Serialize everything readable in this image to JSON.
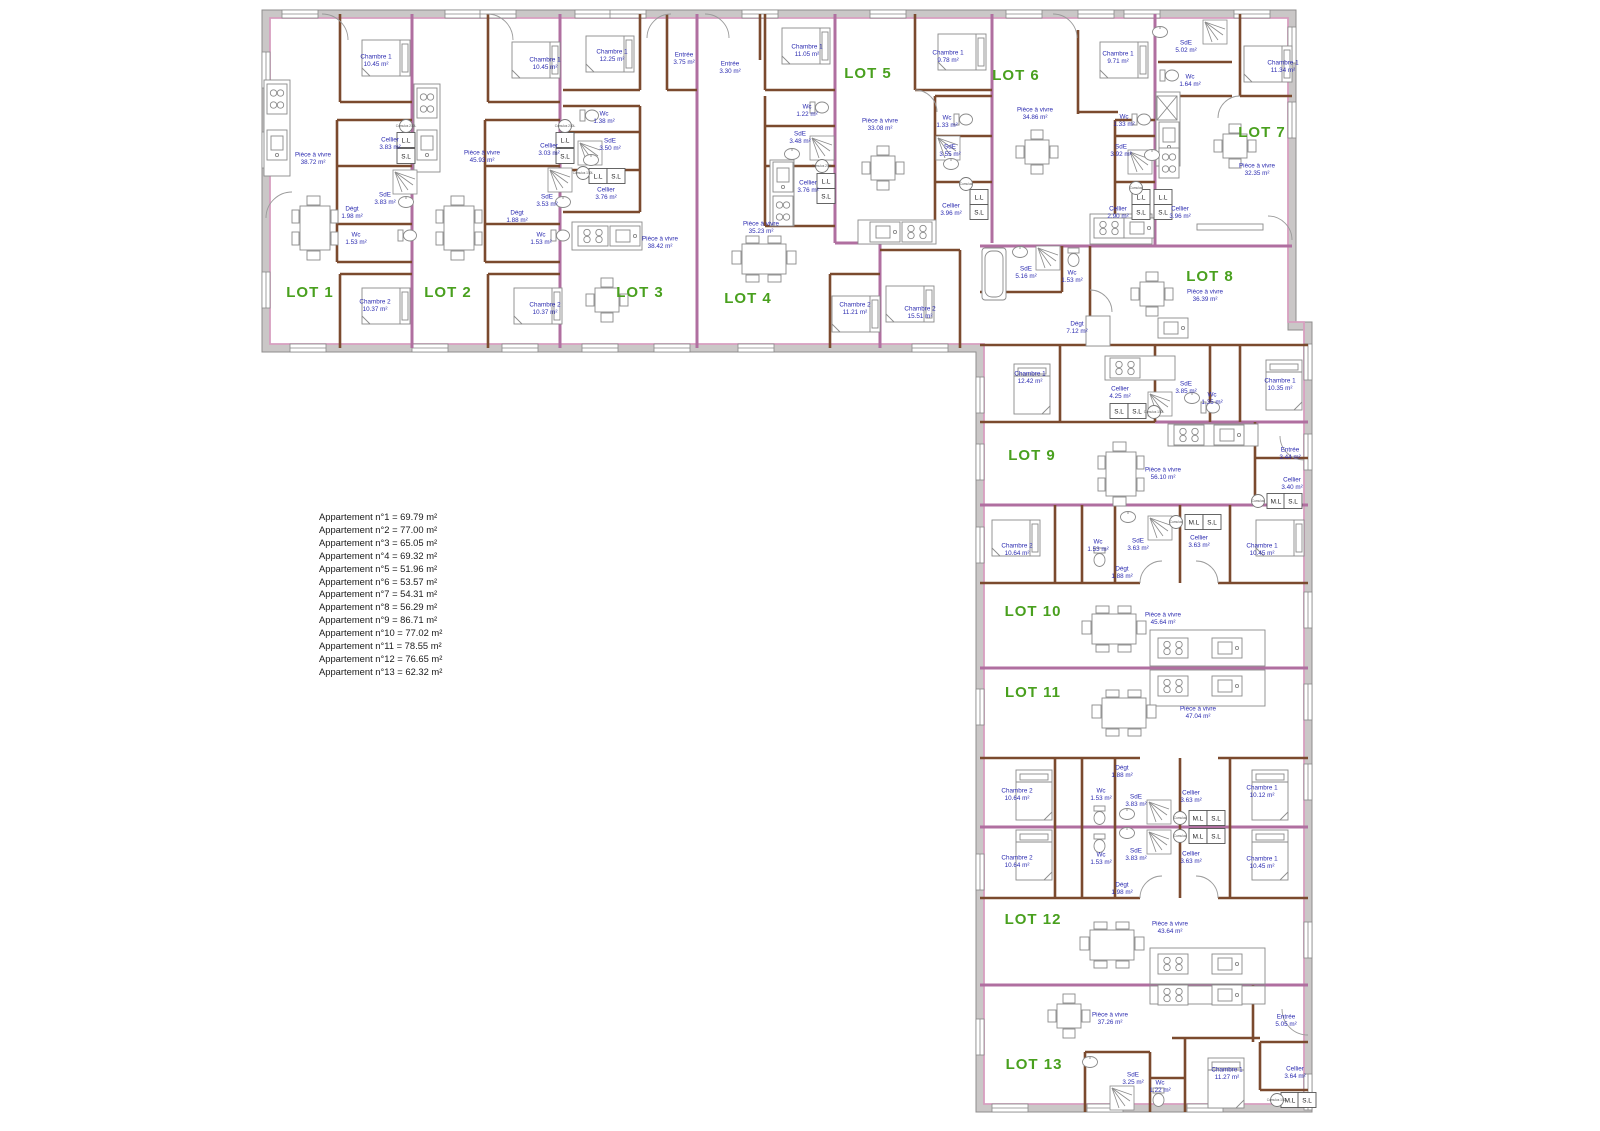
{
  "legend": {
    "items": [
      "Appartement n°1 = 69.79 m²",
      "Appartement n°2 = 77.00 m²",
      "Appartement n°3 = 65.05 m²",
      "Appartement n°4 = 69.32 m²",
      "Appartement n°5 = 51.96 m²",
      "Appartement n°6 = 53.57 m²",
      "Appartement n°7 = 54.31 m²",
      "Appartement n°8 = 56.29 m²",
      "Appartement n°9 = 86.71 m²",
      "Appartement n°10 = 77.02 m²",
      "Appartement n°11 = 78.55 m²",
      "Appartement n°12 = 76.65 m²",
      "Appartement n°13 = 62.32 m²"
    ]
  },
  "lots": [
    {
      "label": "LOT 1",
      "x": 310,
      "y": 297
    },
    {
      "label": "LOT 2",
      "x": 448,
      "y": 297
    },
    {
      "label": "LOT 3",
      "x": 640,
      "y": 297
    },
    {
      "label": "LOT 4",
      "x": 748,
      "y": 303
    },
    {
      "label": "LOT 5",
      "x": 868,
      "y": 78
    },
    {
      "label": "LOT 6",
      "x": 1016,
      "y": 80
    },
    {
      "label": "LOT 7",
      "x": 1262,
      "y": 137
    },
    {
      "label": "LOT 8",
      "x": 1210,
      "y": 281
    },
    {
      "label": "LOT 9",
      "x": 1032,
      "y": 460
    },
    {
      "label": "LOT 10",
      "x": 1033,
      "y": 616
    },
    {
      "label": "LOT 11",
      "x": 1033,
      "y": 697
    },
    {
      "label": "LOT 12",
      "x": 1033,
      "y": 924
    },
    {
      "label": "LOT 13",
      "x": 1034,
      "y": 1069
    }
  ],
  "rooms": [
    {
      "lot": "LOT 1",
      "name": "Chambre 1",
      "area": "10.45 m²",
      "x": 376,
      "y": 60
    },
    {
      "lot": "LOT 1",
      "name": "Pièce à vivre",
      "area": "38.72 m²",
      "x": 313,
      "y": 158
    },
    {
      "lot": "LOT 1",
      "name": "Cellier",
      "area": "3.83 m²",
      "x": 390,
      "y": 143
    },
    {
      "lot": "LOT 1",
      "name": "SdE",
      "area": "3.83 m²",
      "x": 385,
      "y": 198
    },
    {
      "lot": "LOT 1",
      "name": "Dégt",
      "area": "1.98 m²",
      "x": 352,
      "y": 212
    },
    {
      "lot": "LOT 1",
      "name": "Wc",
      "area": "1.53 m²",
      "x": 356,
      "y": 238
    },
    {
      "lot": "LOT 1",
      "name": "Chambre 2",
      "area": "10.37 m²",
      "x": 375,
      "y": 305
    },
    {
      "lot": "LOT 2",
      "name": "Chambre 1",
      "area": "10.45 m²",
      "x": 545,
      "y": 63
    },
    {
      "lot": "LOT 2",
      "name": "Pièce à vivre",
      "area": "45.93 m²",
      "x": 482,
      "y": 156
    },
    {
      "lot": "LOT 2",
      "name": "Cellier",
      "area": "3.03 m²",
      "x": 549,
      "y": 149
    },
    {
      "lot": "LOT 2",
      "name": "SdE",
      "area": "3.53 m²",
      "x": 547,
      "y": 200
    },
    {
      "lot": "LOT 2",
      "name": "Dégt",
      "area": "1.88 m²",
      "x": 517,
      "y": 216
    },
    {
      "lot": "LOT 2",
      "name": "Wc",
      "area": "1.53 m²",
      "x": 541,
      "y": 238
    },
    {
      "lot": "LOT 2",
      "name": "Chambre 2",
      "area": "10.37 m²",
      "x": 545,
      "y": 308
    },
    {
      "lot": "LOT 3",
      "name": "Chambre 1",
      "area": "12.25 m²",
      "x": 612,
      "y": 55
    },
    {
      "lot": "LOT 3",
      "name": "Entrée",
      "area": "3.75 m²",
      "x": 684,
      "y": 58
    },
    {
      "lot": "LOT 3",
      "name": "Wc",
      "area": "1.38 m²",
      "x": 604,
      "y": 117
    },
    {
      "lot": "LOT 3",
      "name": "SdE",
      "area": "3.50 m²",
      "x": 610,
      "y": 144
    },
    {
      "lot": "LOT 3",
      "name": "Cellier",
      "area": "3.76 m²",
      "x": 606,
      "y": 193
    },
    {
      "lot": "LOT 3",
      "name": "Pièce à vivre",
      "area": "38.42 m²",
      "x": 660,
      "y": 242
    },
    {
      "lot": "LOT 4",
      "name": "Entrée",
      "area": "3.30 m²",
      "x": 730,
      "y": 67
    },
    {
      "lot": "LOT 4",
      "name": "Chambre 1",
      "area": "11.05 m²",
      "x": 807,
      "y": 50
    },
    {
      "lot": "LOT 4",
      "name": "Wc",
      "area": "1.22 m²",
      "x": 807,
      "y": 110
    },
    {
      "lot": "LOT 4",
      "name": "SdE",
      "area": "3.48 m²",
      "x": 800,
      "y": 137
    },
    {
      "lot": "LOT 4",
      "name": "Cellier",
      "area": "3.76 m²",
      "x": 808,
      "y": 186
    },
    {
      "lot": "LOT 4",
      "name": "Pièce à vivre",
      "area": "35.23 m²",
      "x": 761,
      "y": 227
    },
    {
      "lot": "LOT 4",
      "name": "Chambre 2",
      "area": "11.21 m²",
      "x": 855,
      "y": 308
    },
    {
      "lot": "LOT 5",
      "name": "Chambre 1",
      "area": "9.78 m²",
      "x": 948,
      "y": 56
    },
    {
      "lot": "LOT 5",
      "name": "Pièce à vivre",
      "area": "33.08 m²",
      "x": 880,
      "y": 124
    },
    {
      "lot": "LOT 5",
      "name": "Wc",
      "area": "1.33 m²",
      "x": 947,
      "y": 121
    },
    {
      "lot": "LOT 5",
      "name": "SdE",
      "area": "3.55 m²",
      "x": 950,
      "y": 150
    },
    {
      "lot": "LOT 5",
      "name": "Cellier",
      "area": "3.96 m²",
      "x": 951,
      "y": 209
    },
    {
      "lot": "LOT 5",
      "name": "Chambre 2",
      "area": "15.51 m²",
      "x": 920,
      "y": 312
    },
    {
      "lot": "LOT 6",
      "name": "Chambre 1",
      "area": "9.71 m²",
      "x": 1118,
      "y": 57
    },
    {
      "lot": "LOT 6",
      "name": "Pièce à vivre",
      "area": "34.86 m²",
      "x": 1035,
      "y": 113
    },
    {
      "lot": "LOT 6",
      "name": "Wc",
      "area": "1.33 m²",
      "x": 1124,
      "y": 120
    },
    {
      "lot": "LOT 6",
      "name": "SdE",
      "area": "3.92 m²",
      "x": 1121,
      "y": 150
    },
    {
      "lot": "LOT 6",
      "name": "Cellier",
      "area": "2.90 m²",
      "x": 1118,
      "y": 212
    },
    {
      "lot": "LOT 7",
      "name": "SdE",
      "area": "5.02 m²",
      "x": 1186,
      "y": 46
    },
    {
      "lot": "LOT 7",
      "name": "Wc",
      "area": "1.64 m²",
      "x": 1190,
      "y": 80
    },
    {
      "lot": "LOT 7",
      "name": "Chambre 1",
      "area": "11.34 m²",
      "x": 1283,
      "y": 66
    },
    {
      "lot": "LOT 7",
      "name": "Pièce à vivre",
      "area": "32.35 m²",
      "x": 1257,
      "y": 169
    },
    {
      "lot": "LOT 7",
      "name": "Cellier",
      "area": "3.96 m²",
      "x": 1180,
      "y": 212
    },
    {
      "lot": "LOT 8",
      "name": "SdE",
      "area": "5.16 m²",
      "x": 1026,
      "y": 272
    },
    {
      "lot": "LOT 8",
      "name": "Wc",
      "area": "1.53 m²",
      "x": 1072,
      "y": 276
    },
    {
      "lot": "LOT 8",
      "name": "Pièce à vivre",
      "area": "36.39 m²",
      "x": 1205,
      "y": 295
    },
    {
      "lot": "LOT 8",
      "name": "Dégt",
      "area": "7.12 m²",
      "x": 1077,
      "y": 327
    },
    {
      "lot": "LOT 8",
      "name": "Chambre 1",
      "area": "12.42 m²",
      "x": 1030,
      "y": 377
    },
    {
      "lot": "LOT 8",
      "name": "Cellier",
      "area": "4.25 m²",
      "x": 1120,
      "y": 392
    },
    {
      "lot": "LOT 8",
      "name": "SdE",
      "area": "3.85 m²",
      "x": 1186,
      "y": 387
    },
    {
      "lot": "LOT 8",
      "name": "Wc",
      "area": "1.35 m²",
      "x": 1212,
      "y": 398
    },
    {
      "lot": "LOT 8",
      "name": "Chambre 1",
      "area": "10.35 m²",
      "x": 1280,
      "y": 384
    },
    {
      "lot": "LOT 9",
      "name": "Pièce à vivre",
      "area": "56.10 m²",
      "x": 1163,
      "y": 473
    },
    {
      "lot": "LOT 9",
      "name": "Entrée",
      "area": "3.44 m²",
      "x": 1290,
      "y": 453
    },
    {
      "lot": "LOT 9",
      "name": "Cellier",
      "area": "3.40 m²",
      "x": 1292,
      "y": 483
    },
    {
      "lot": "LOT 10",
      "name": "Chambre 2",
      "area": "10.64 m²",
      "x": 1017,
      "y": 549
    },
    {
      "lot": "LOT 10",
      "name": "Wc",
      "area": "1.53 m²",
      "x": 1098,
      "y": 545
    },
    {
      "lot": "LOT 10",
      "name": "SdE",
      "area": "3.63 m²",
      "x": 1138,
      "y": 544
    },
    {
      "lot": "LOT 10",
      "name": "Cellier",
      "area": "3.63 m²",
      "x": 1199,
      "y": 541
    },
    {
      "lot": "LOT 10",
      "name": "Dégt",
      "area": "1.88 m²",
      "x": 1122,
      "y": 572
    },
    {
      "lot": "LOT 10",
      "name": "Chambre 1",
      "area": "10.45 m²",
      "x": 1262,
      "y": 549
    },
    {
      "lot": "LOT 10",
      "name": "Pièce à vivre",
      "area": "45.64 m²",
      "x": 1163,
      "y": 618
    },
    {
      "lot": "LOT 11",
      "name": "Pièce à vivre",
      "area": "47.04 m²",
      "x": 1198,
      "y": 712
    },
    {
      "lot": "LOT 11",
      "name": "Dégt",
      "area": "1.88 m²",
      "x": 1122,
      "y": 771
    },
    {
      "lot": "LOT 11",
      "name": "Chambre 2",
      "area": "10.64 m²",
      "x": 1017,
      "y": 794
    },
    {
      "lot": "LOT 11",
      "name": "Wc",
      "area": "1.53 m²",
      "x": 1101,
      "y": 794
    },
    {
      "lot": "LOT 11",
      "name": "SdE",
      "area": "3.83 m²",
      "x": 1136,
      "y": 800
    },
    {
      "lot": "LOT 11",
      "name": "Cellier",
      "area": "3.63 m²",
      "x": 1191,
      "y": 796
    },
    {
      "lot": "LOT 11",
      "name": "Chambre 1",
      "area": "10.12 m²",
      "x": 1262,
      "y": 791
    },
    {
      "lot": "LOT 12",
      "name": "Chambre 2",
      "area": "10.64 m²",
      "x": 1017,
      "y": 861
    },
    {
      "lot": "LOT 12",
      "name": "Wc",
      "area": "1.53 m²",
      "x": 1101,
      "y": 858
    },
    {
      "lot": "LOT 12",
      "name": "SdE",
      "area": "3.83 m²",
      "x": 1136,
      "y": 854
    },
    {
      "lot": "LOT 12",
      "name": "Cellier",
      "area": "3.63 m²",
      "x": 1191,
      "y": 857
    },
    {
      "lot": "LOT 12",
      "name": "Chambre 1",
      "area": "10.45 m²",
      "x": 1262,
      "y": 862
    },
    {
      "lot": "LOT 12",
      "name": "Dégt",
      "area": "1.98 m²",
      "x": 1122,
      "y": 888
    },
    {
      "lot": "LOT 12",
      "name": "Pièce à vivre",
      "area": "43.64 m²",
      "x": 1170,
      "y": 927
    },
    {
      "lot": "LOT 13",
      "name": "Pièce à vivre",
      "area": "37.26 m²",
      "x": 1110,
      "y": 1018
    },
    {
      "lot": "LOT 13",
      "name": "Entrée",
      "area": "5.05 m²",
      "x": 1286,
      "y": 1020
    },
    {
      "lot": "LOT 13",
      "name": "SdE",
      "area": "3.25 m²",
      "x": 1133,
      "y": 1078
    },
    {
      "lot": "LOT 13",
      "name": "Wc",
      "area": "1.22 m²",
      "x": 1160,
      "y": 1086
    },
    {
      "lot": "LOT 13",
      "name": "Chambre 1",
      "area": "11.27 m²",
      "x": 1227,
      "y": 1073
    },
    {
      "lot": "LOT 13",
      "name": "Cellier",
      "area": "3.64 m²",
      "x": 1295,
      "y": 1072
    }
  ],
  "utility_boxes": [
    {
      "label": "L.L",
      "x": 406,
      "y": 140
    },
    {
      "label": "S.L",
      "x": 406,
      "y": 156
    },
    {
      "label": "L.L",
      "x": 565,
      "y": 140
    },
    {
      "label": "S.L",
      "x": 565,
      "y": 156
    },
    {
      "label": "L.L",
      "x": 598,
      "y": 176
    },
    {
      "label": "S.L",
      "x": 616,
      "y": 176
    },
    {
      "label": "L.L",
      "x": 826,
      "y": 181
    },
    {
      "label": "S.L",
      "x": 826,
      "y": 196
    },
    {
      "label": "L.L",
      "x": 979,
      "y": 197
    },
    {
      "label": "S.L",
      "x": 979,
      "y": 212
    },
    {
      "label": "L.L",
      "x": 1141,
      "y": 197
    },
    {
      "label": "S.L",
      "x": 1141,
      "y": 212
    },
    {
      "label": "L.L",
      "x": 1163,
      "y": 197
    },
    {
      "label": "S.L",
      "x": 1163,
      "y": 212
    },
    {
      "label": "S.L",
      "x": 1119,
      "y": 411
    },
    {
      "label": "S.L",
      "x": 1137,
      "y": 411
    },
    {
      "label": "M.L",
      "x": 1276,
      "y": 501
    },
    {
      "label": "S.L",
      "x": 1293,
      "y": 501
    },
    {
      "label": "M.L",
      "x": 1194,
      "y": 522
    },
    {
      "label": "S.L",
      "x": 1212,
      "y": 522
    },
    {
      "label": "M.L",
      "x": 1198,
      "y": 818
    },
    {
      "label": "S.L",
      "x": 1216,
      "y": 818
    },
    {
      "label": "M.L",
      "x": 1198,
      "y": 836
    },
    {
      "label": "S.L",
      "x": 1216,
      "y": 836
    },
    {
      "label": "M.L",
      "x": 1290,
      "y": 1100
    },
    {
      "label": "S.L",
      "x": 1307,
      "y": 1100
    }
  ],
  "water_heaters": [
    {
      "label": "Cumulus 200L",
      "x": 406,
      "y": 126
    },
    {
      "label": "Cumulus 200L",
      "x": 565,
      "y": 126
    },
    {
      "label": "Cumulus 150L",
      "x": 583,
      "y": 173
    },
    {
      "label": "Cumulus 200L",
      "x": 822,
      "y": 166
    },
    {
      "label": "Cumulus",
      "x": 966,
      "y": 184
    },
    {
      "label": "Cumulus",
      "x": 1136,
      "y": 188
    },
    {
      "label": "Cumulus 150L",
      "x": 1154,
      "y": 412
    },
    {
      "label": "Cumulus",
      "x": 1258,
      "y": 501
    },
    {
      "label": "Cumulus",
      "x": 1176,
      "y": 522
    },
    {
      "label": "Cumulus",
      "x": 1180,
      "y": 818
    },
    {
      "label": "Cumulus",
      "x": 1180,
      "y": 836
    },
    {
      "label": "Cumulus 150L",
      "x": 1277,
      "y": 1100
    }
  ],
  "colors": {
    "lot_label": "#49a01e",
    "room_label": "#2b2bb0",
    "partition_wall": "#7b4a2e",
    "party_wall": "#b06fa0",
    "outer_wall": "#cac7c7",
    "insulation_line": "#d79fc0"
  }
}
